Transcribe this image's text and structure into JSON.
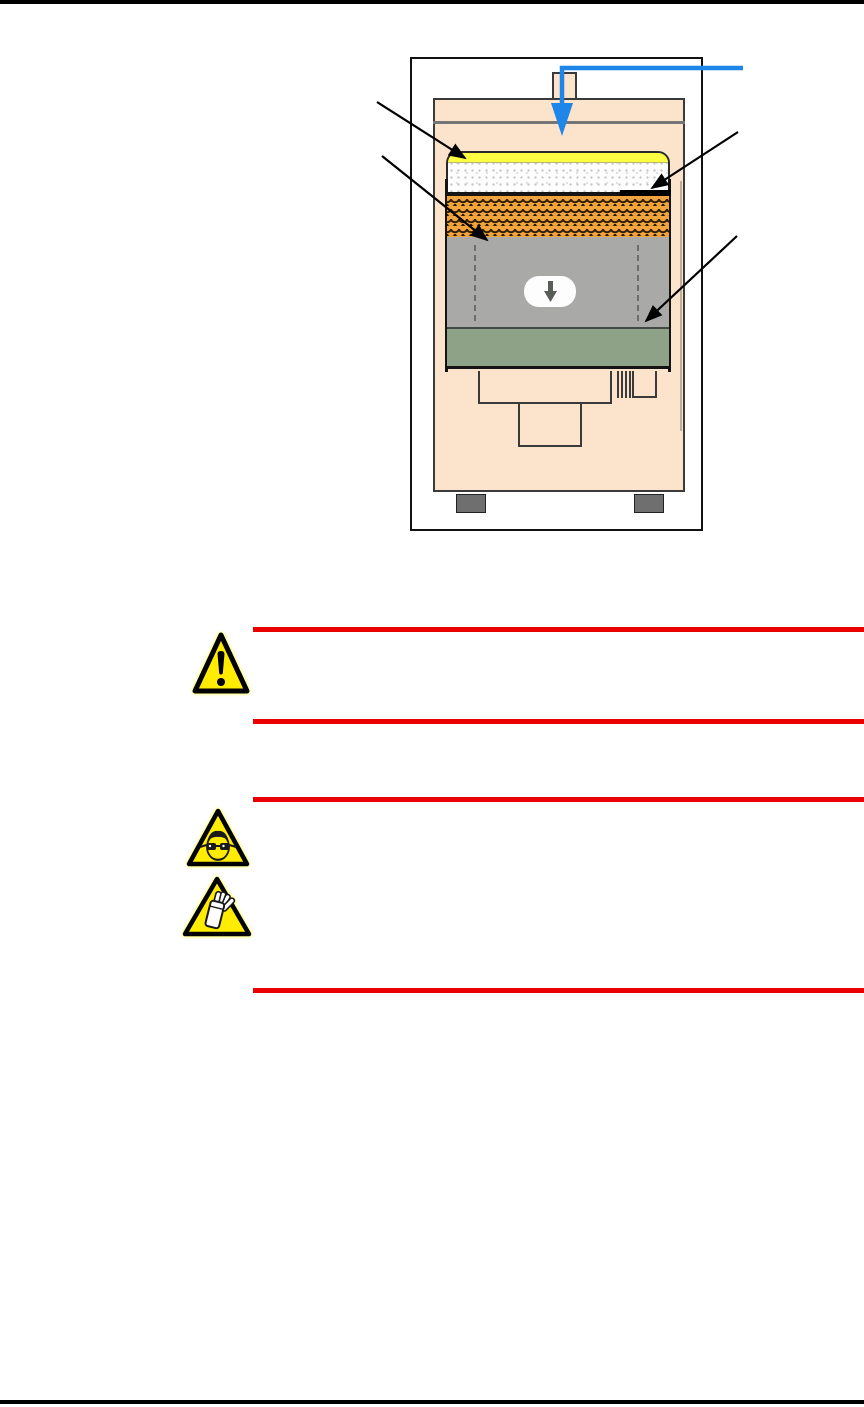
{
  "page": {
    "width_px": 864,
    "height_px": 1407,
    "background": "#ffffff",
    "top_rule_color": "#000000",
    "footer_rule_color": "#000000"
  },
  "figure": {
    "name": "extractor-cross-section-diagram",
    "frame_color": "#111111",
    "colors": {
      "cabinet": "#fbe3cc",
      "outline": "#3a3a3a",
      "seal_strip": "#feff43",
      "foam_pad": "#fdfdfd",
      "mesh_filter": "#f2a43c",
      "mesh_line": "#2e1c03",
      "rim": "#141414",
      "chamber": "#a9aaa8",
      "chamber_arrow": "#585d58",
      "tray": "#8da287",
      "feet": "#6f6f6f",
      "flow_arrow": "#1d86e8",
      "callout_arrow": "#000000"
    },
    "parts": [
      {
        "name": "inlet-port"
      },
      {
        "name": "seal-strip"
      },
      {
        "name": "foam-pre-filter"
      },
      {
        "name": "mesh-filter"
      },
      {
        "name": "filter-rim"
      },
      {
        "name": "collection-chamber"
      },
      {
        "name": "chamber-flow-arrow"
      },
      {
        "name": "base-tray"
      },
      {
        "name": "outlet-housing"
      },
      {
        "name": "feet"
      }
    ],
    "callout_count": 4,
    "inlet_flow_direction": "down"
  },
  "warnings": [
    {
      "rule_color": "#ea0000",
      "icons": [
        {
          "name": "general-warning-icon",
          "fill": "#ffec00",
          "stroke": "#000000"
        }
      ]
    },
    {
      "rule_color": "#ea0000",
      "icons": [
        {
          "name": "eye-protection-icon",
          "fill": "#ffec00",
          "stroke": "#000000"
        },
        {
          "name": "hand-protection-icon",
          "fill": "#ffec00",
          "stroke": "#000000"
        }
      ]
    }
  ]
}
